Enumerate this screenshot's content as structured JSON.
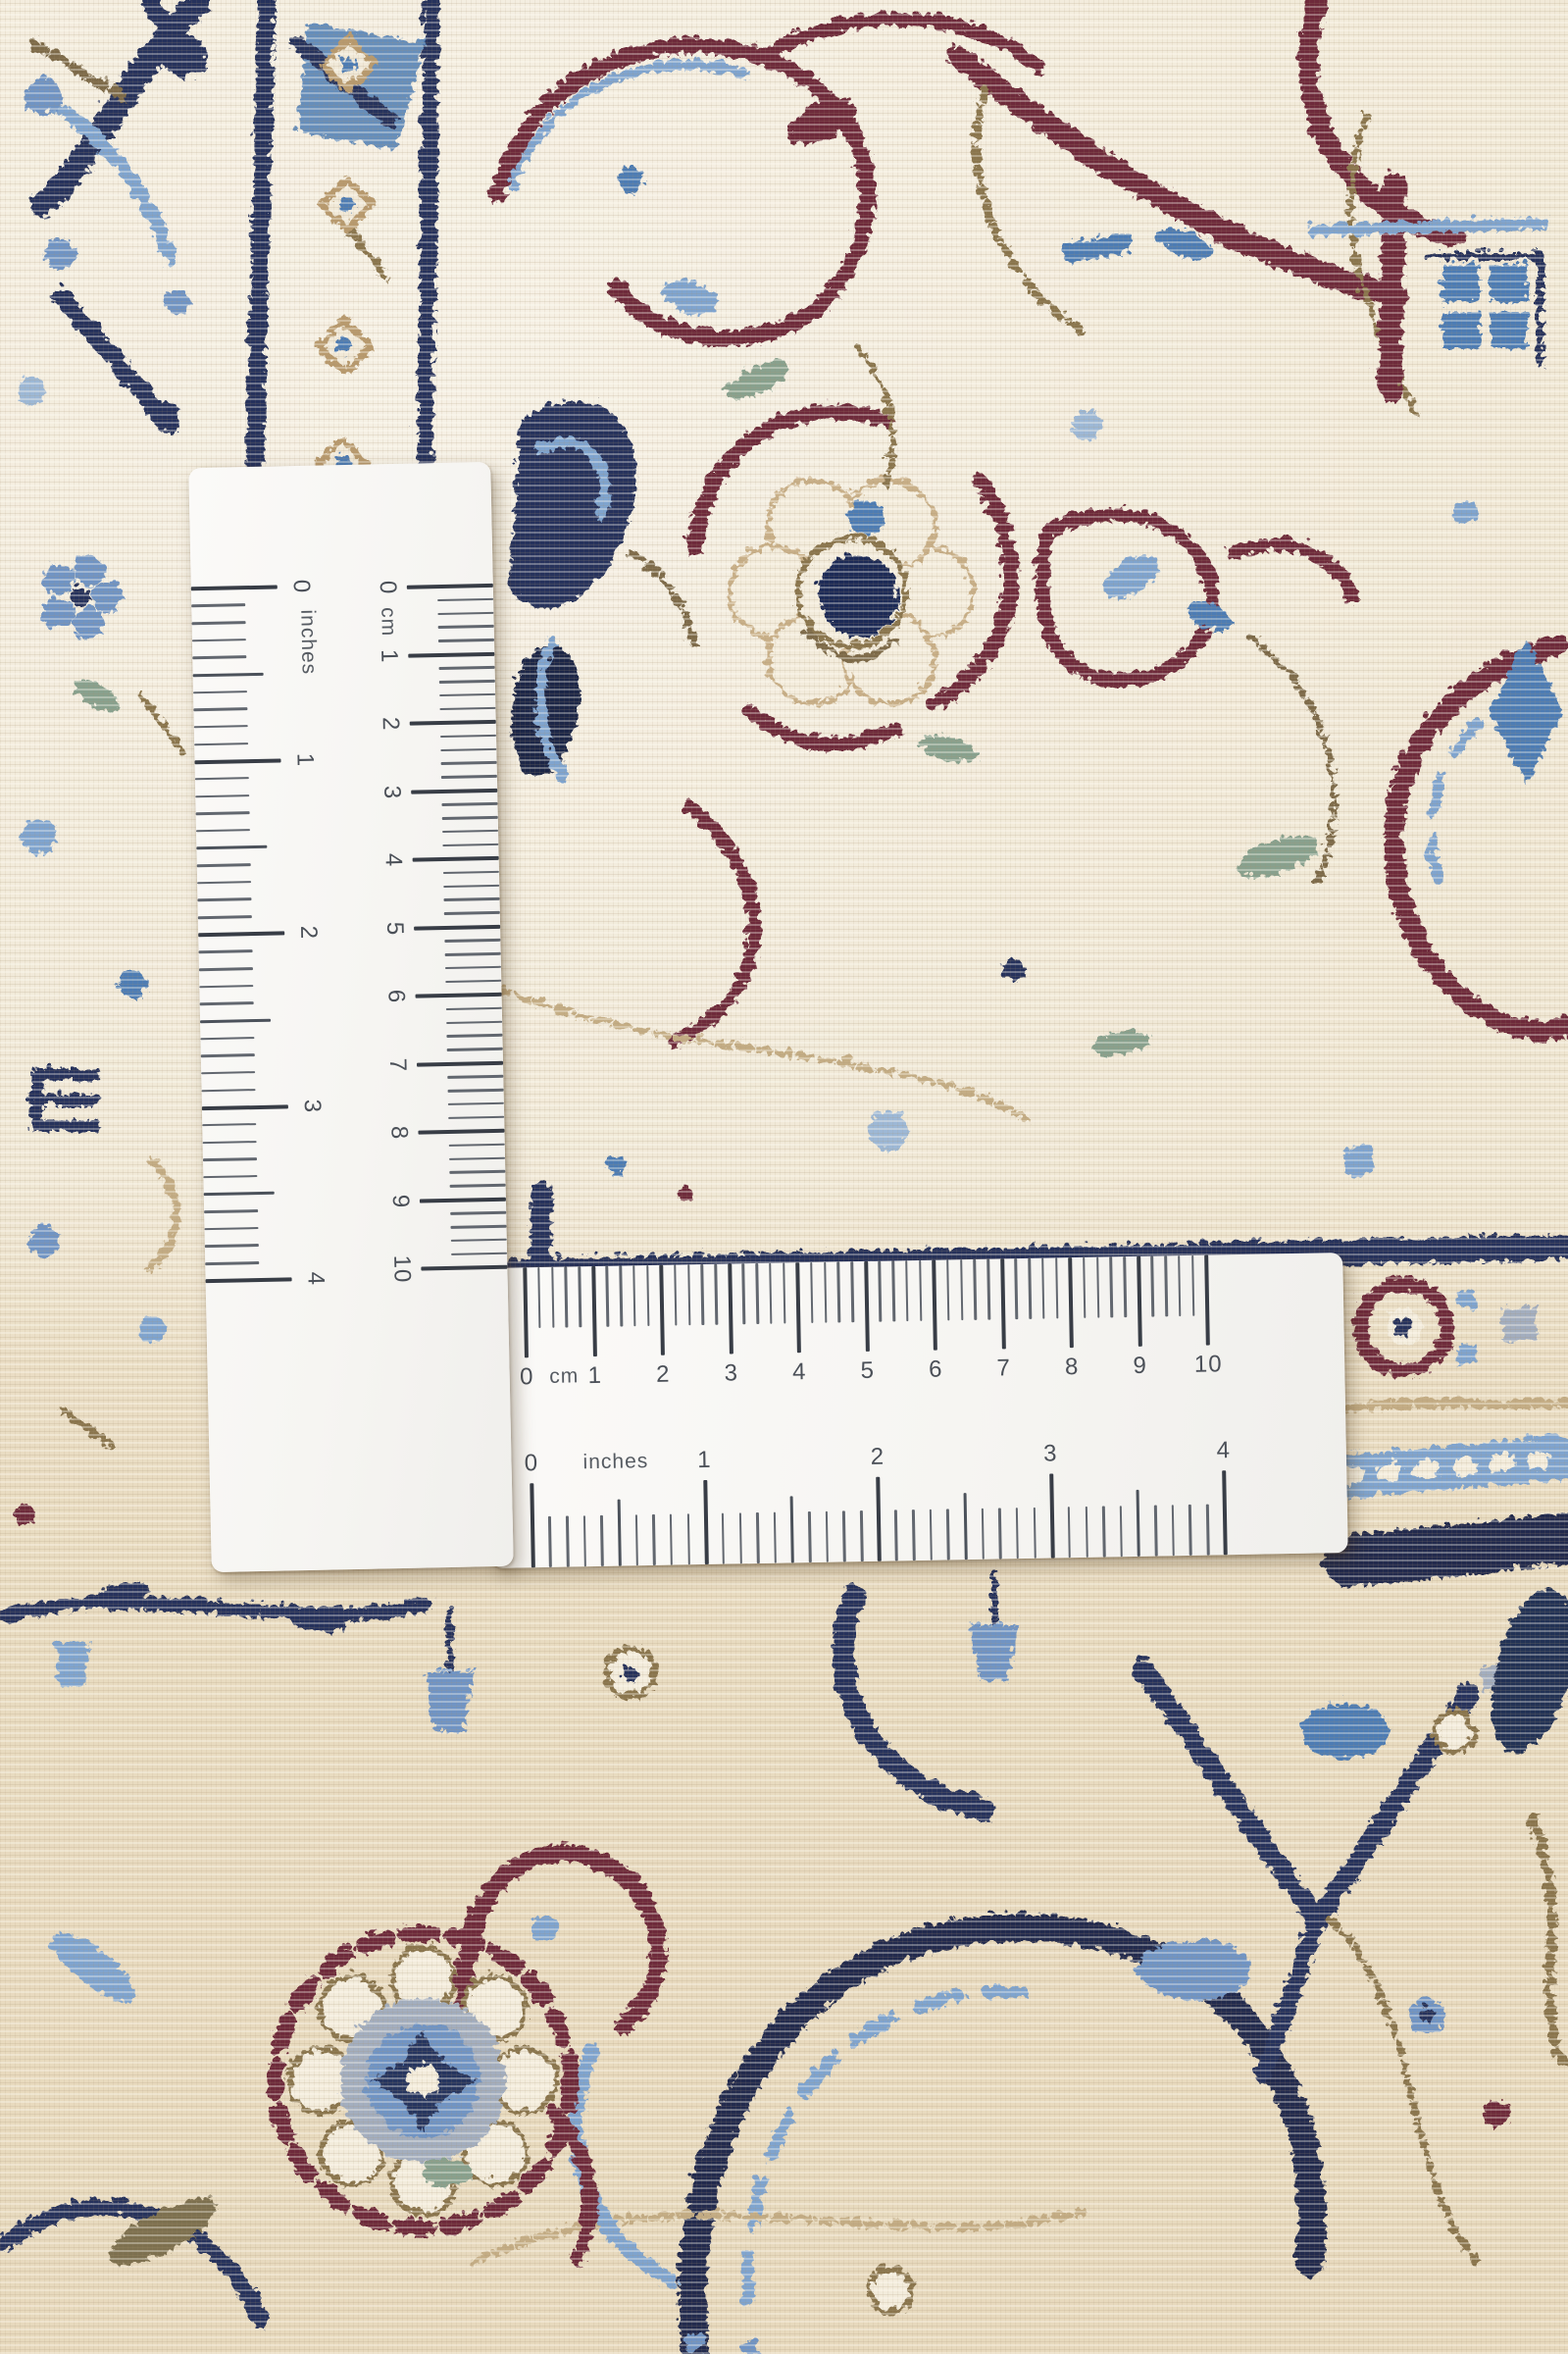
{
  "scene": {
    "subject": "Close-up photograph of a cream Persian Nain carpet corner with floral arabesque pattern",
    "overlay": "Two white measuring rulers laid on the carpet in an L arrangement, one vertical and one horizontal"
  },
  "palette": {
    "carpet_cream": "#f1e9d7",
    "border_beige": "#e7d9bd",
    "stitch_shadow": "#a89270",
    "navy": "#27335c",
    "dark_navy": "#1f2747",
    "steel_blue": "#4e7cb4",
    "light_blue": "#7fa4cf",
    "pale_blue": "#9db8d6",
    "grey_blue": "#a3aebf",
    "maroon": "#6e2c3a",
    "brown": "#7d6a4a",
    "tan": "#c4ad85",
    "sage": "#88a18e",
    "ruler_white": "#f6f5f2",
    "tick_major": "#383d46",
    "tick_minor": "#62676f",
    "label_color": "#4b5058"
  },
  "vertical_ruler": {
    "orientation": "vertical",
    "cm_scale": {
      "side": "right",
      "unit_label": "cm",
      "numbers": [
        "0",
        "1",
        "2",
        "3",
        "4",
        "5",
        "6",
        "7",
        "8",
        "9",
        "10"
      ]
    },
    "inch_scale": {
      "side": "left",
      "unit_label": "inches",
      "numbers": [
        "0",
        "1",
        "2",
        "3",
        "4"
      ]
    }
  },
  "horizontal_ruler": {
    "orientation": "horizontal",
    "cm_scale": {
      "side": "top",
      "unit_label": "cm",
      "numbers": [
        "0",
        "1",
        "2",
        "3",
        "4",
        "5",
        "6",
        "7",
        "8",
        "9",
        "10"
      ]
    },
    "inch_scale": {
      "side": "bottom",
      "unit_label": "inches",
      "numbers": [
        "0",
        "1",
        "2",
        "3",
        "4"
      ]
    }
  }
}
